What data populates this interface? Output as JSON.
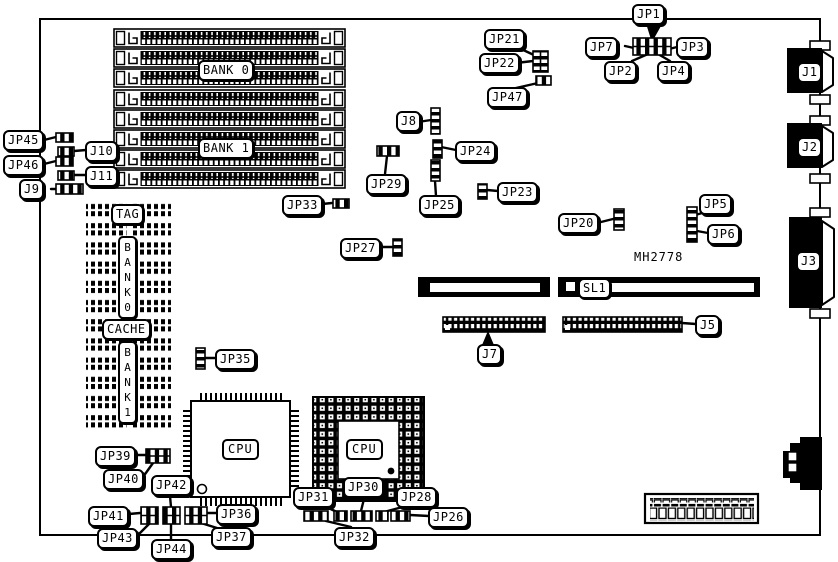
{
  "board": {
    "part_number": "MH2778"
  },
  "memory": {
    "bank0": "BANK 0",
    "bank1": "BANK 1"
  },
  "cache": {
    "tag": "TAG",
    "bank0_vertical": "BANK0",
    "cache": "CACHE",
    "bank1_vertical": "BANK1"
  },
  "processors": {
    "qfp_cpu": "CPU",
    "pga_cpu": "CPU"
  },
  "slots": {
    "sl1": "SL1"
  },
  "connectors": {
    "j1": "J1",
    "j2": "J2",
    "j3": "J3",
    "j5": "J5",
    "j7": "J7",
    "j8": "J8",
    "j9": "J9",
    "j10": "J10",
    "j11": "J11"
  },
  "jumpers": {
    "jp1": "JP1",
    "jp2": "JP2",
    "jp3": "JP3",
    "jp4": "JP4",
    "jp5": "JP5",
    "jp6": "JP6",
    "jp7": "JP7",
    "jp20": "JP20",
    "jp21": "JP21",
    "jp22": "JP22",
    "jp23": "JP23",
    "jp24": "JP24",
    "jp25": "JP25",
    "jp26": "JP26",
    "jp27": "JP27",
    "jp28": "JP28",
    "jp29": "JP29",
    "jp30": "JP30",
    "jp31": "JP31",
    "jp32": "JP32",
    "jp33": "JP33",
    "jp35": "JP35",
    "jp36": "JP36",
    "jp37": "JP37",
    "jp39": "JP39",
    "jp40": "JP40",
    "jp41": "JP41",
    "jp42": "JP42",
    "jp43": "JP43",
    "jp44": "JP44",
    "jp45": "JP45",
    "jp46": "JP46",
    "jp47": "JP47"
  }
}
